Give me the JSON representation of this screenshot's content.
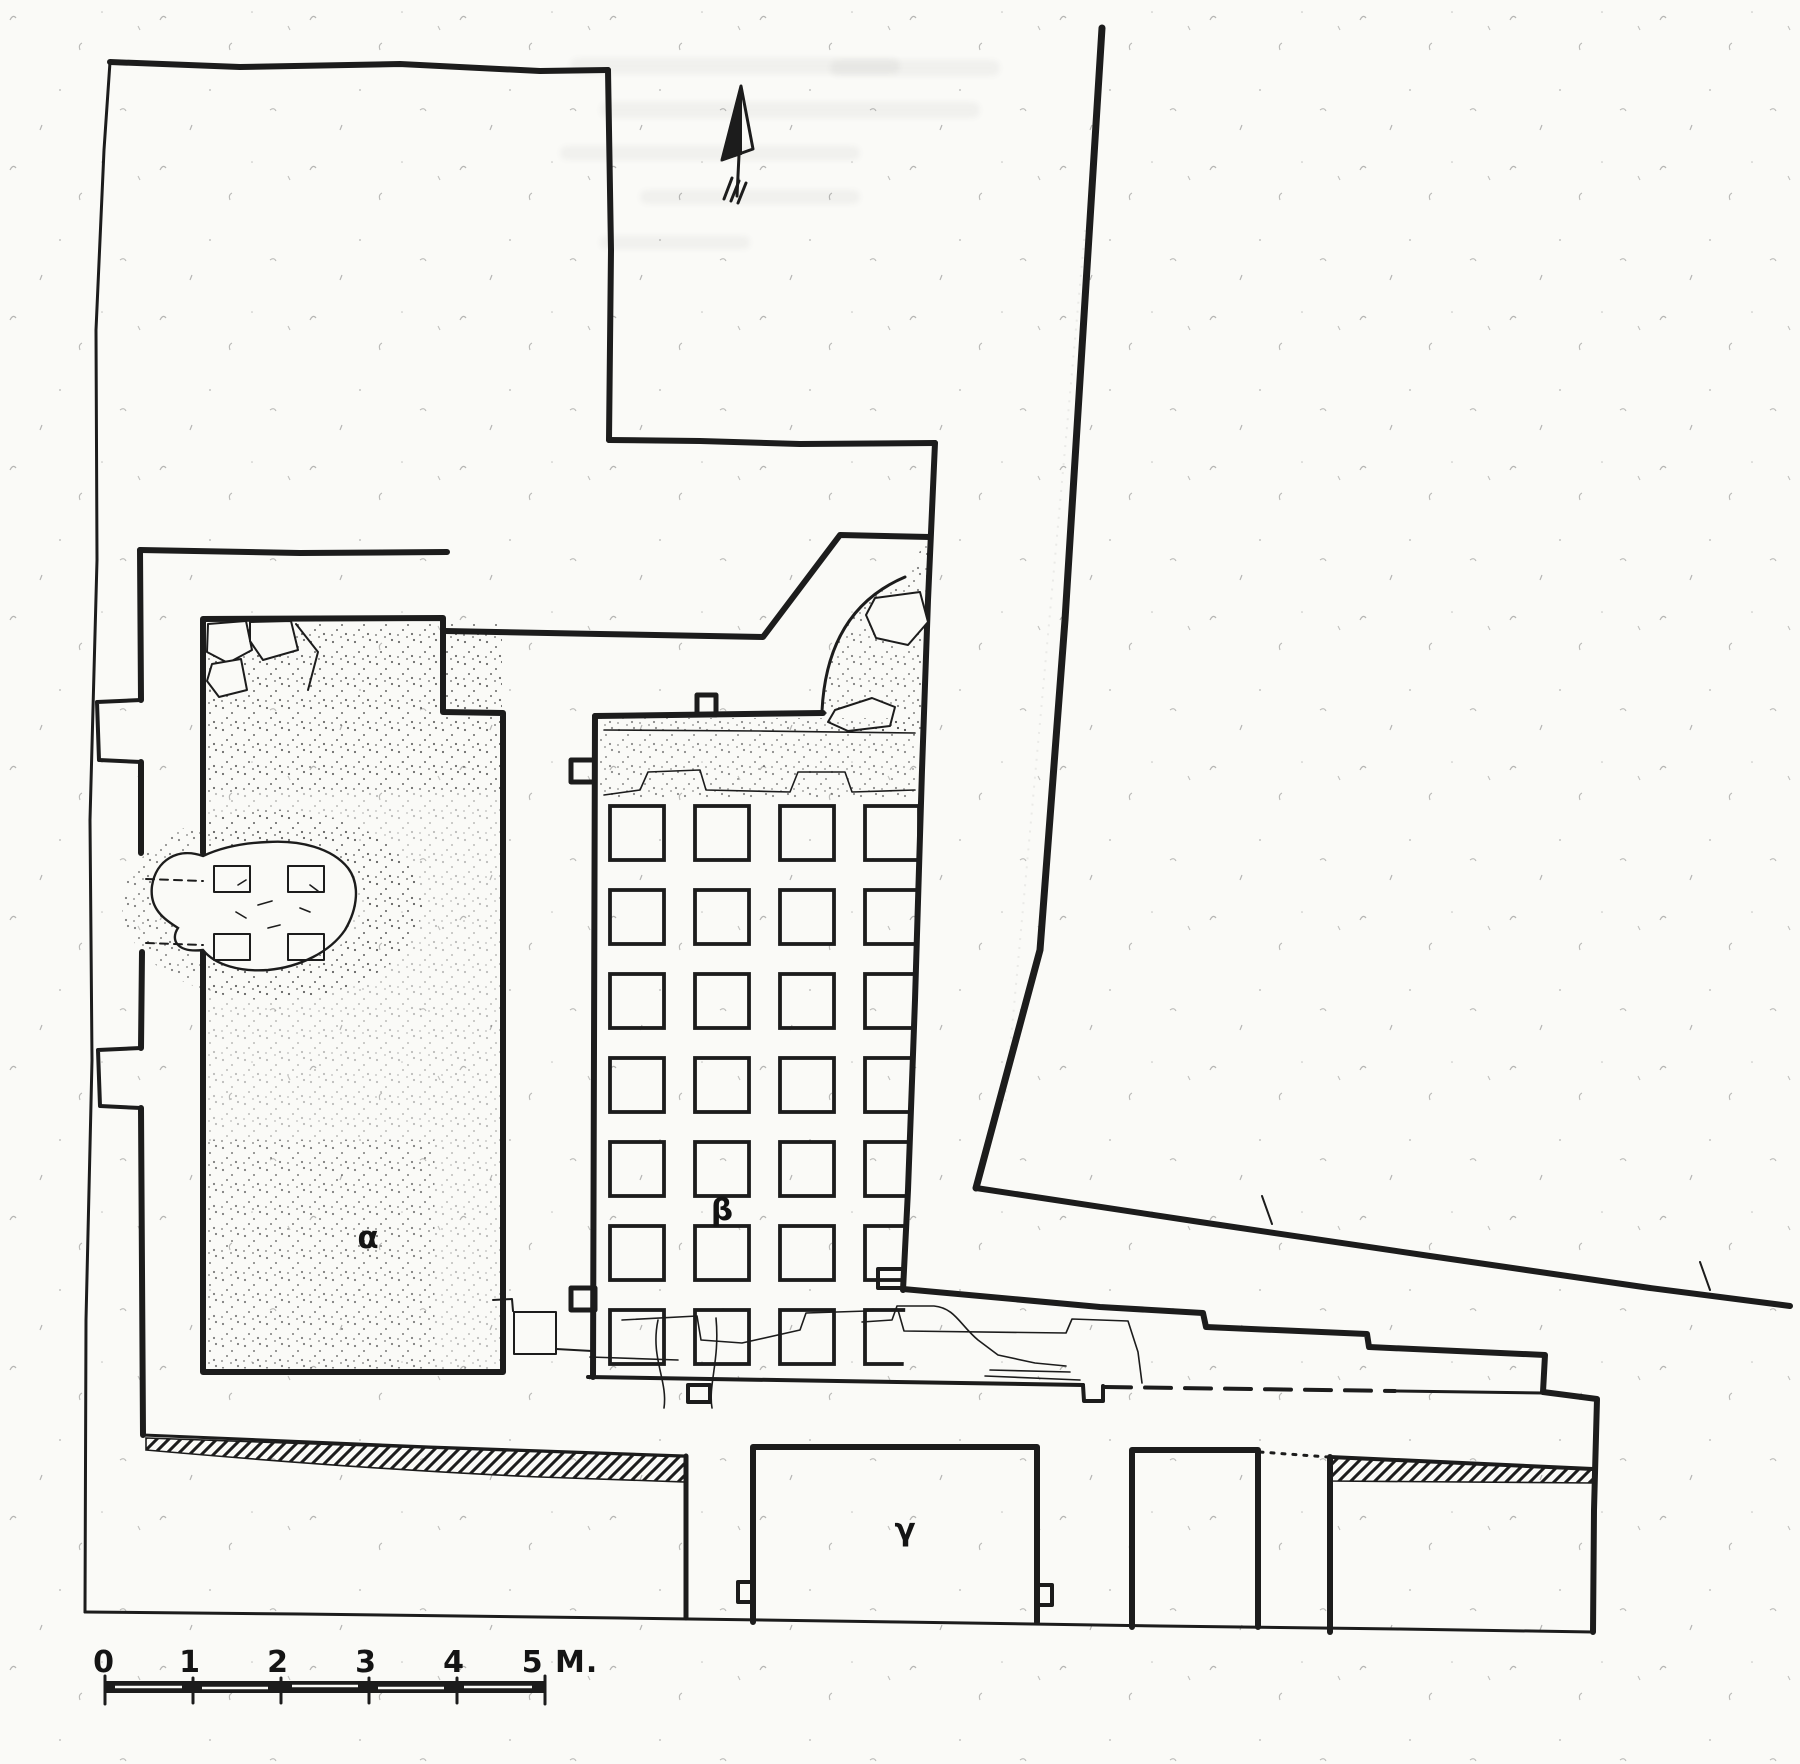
{
  "figure": {
    "ink_color": "#1c1c1c",
    "paper_color": "#fafaf7"
  },
  "labels": {
    "alpha": "α",
    "beta": "β",
    "gamma": "γ"
  },
  "scale_bar": {
    "tick_labels": [
      "0",
      "1",
      "2",
      "3",
      "4",
      "5 M."
    ]
  },
  "grid": {
    "cols": 4,
    "rows": 7,
    "x0": 610,
    "y0": 806,
    "dx": 85,
    "dy": 84,
    "size": 54
  }
}
